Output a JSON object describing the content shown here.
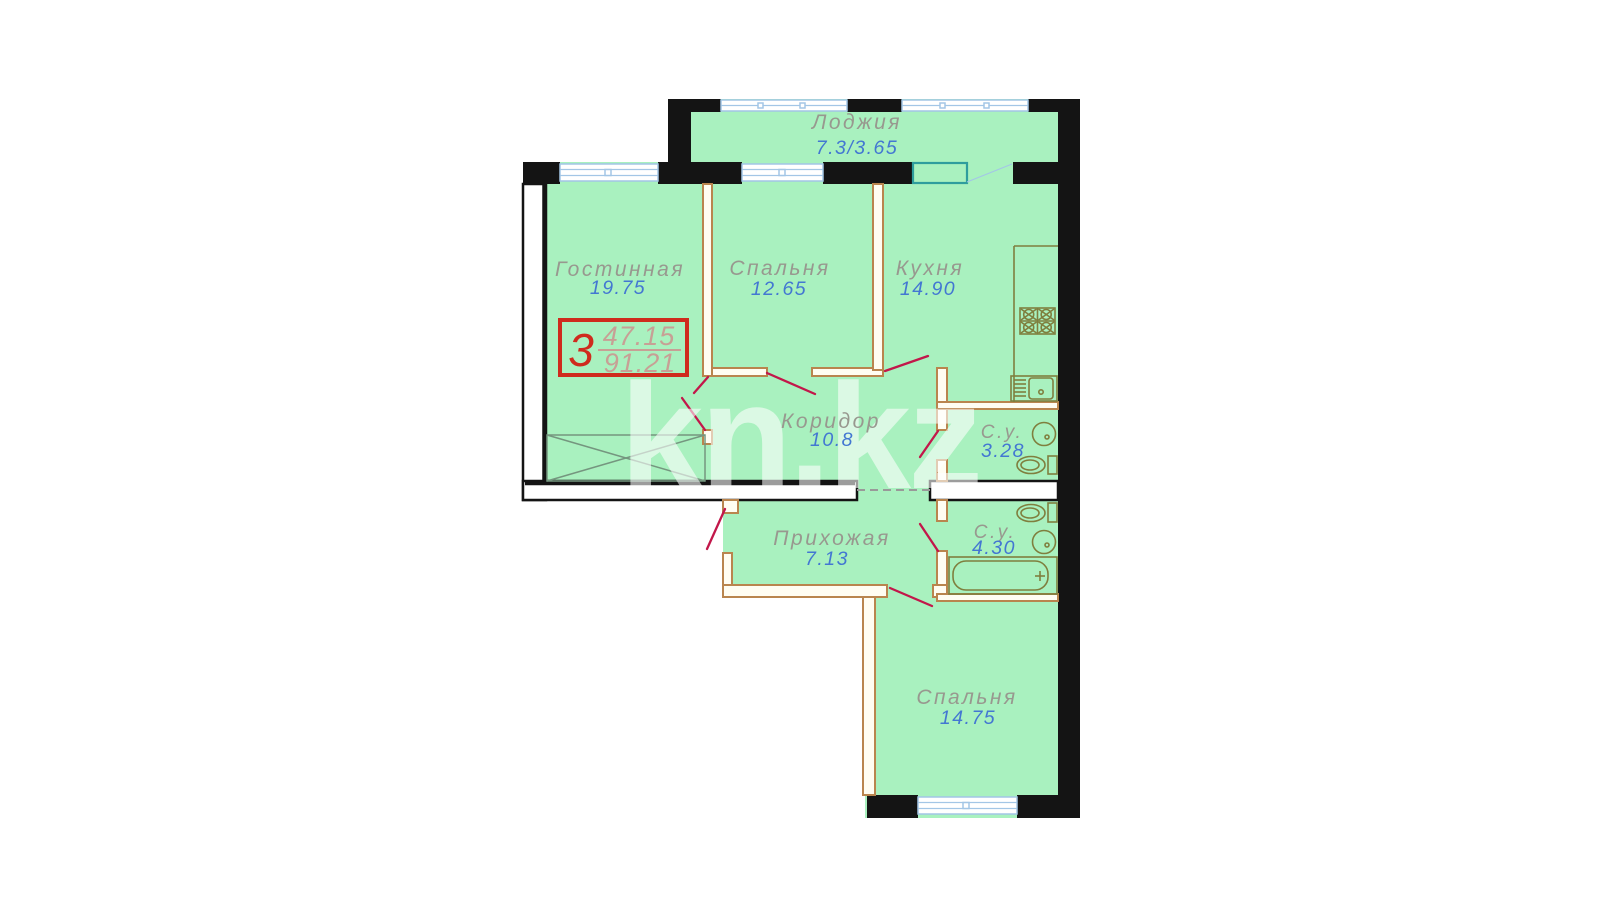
{
  "watermark": {
    "text": "kn.kz"
  },
  "info_box": {
    "rooms_count": "3",
    "living_area": "47.15",
    "total_area": "91.21"
  },
  "rooms": [
    {
      "id": "loggia",
      "name": "Лоджия",
      "area": "7.3/3.65"
    },
    {
      "id": "living",
      "name": "Гостинная",
      "area": "19.75"
    },
    {
      "id": "bedroom-1",
      "name": "Спальня",
      "area": "12.65"
    },
    {
      "id": "kitchen",
      "name": "Кухня",
      "area": "14.90"
    },
    {
      "id": "corridor",
      "name": "Коридор",
      "area": "10.8"
    },
    {
      "id": "bathroom-1",
      "name": "С.у.",
      "area": "3.28"
    },
    {
      "id": "hallway",
      "name": "Прихожая",
      "area": "7.13"
    },
    {
      "id": "bathroom-2",
      "name": "С.у.",
      "area": "4.30"
    },
    {
      "id": "bedroom-2",
      "name": "Спальня",
      "area": "14.75"
    }
  ],
  "colors": {
    "floor_fill": "#a9f1bf",
    "wall_black": "#141414",
    "partition_tan": "#b9854e",
    "door_swing_red": "#c2174a",
    "window_blue": "#a3c6e6",
    "balcony_unit_teal": "#2f9d9d",
    "room_name_gray": "#98988f",
    "area_number_blue": "#4377d2",
    "info_box_red": "#cf2b1d",
    "info_box_numbers": "#c7a095",
    "fixture_olive": "#7f7f3e",
    "watermark_white": "rgba(255,255,255,0.58)"
  }
}
